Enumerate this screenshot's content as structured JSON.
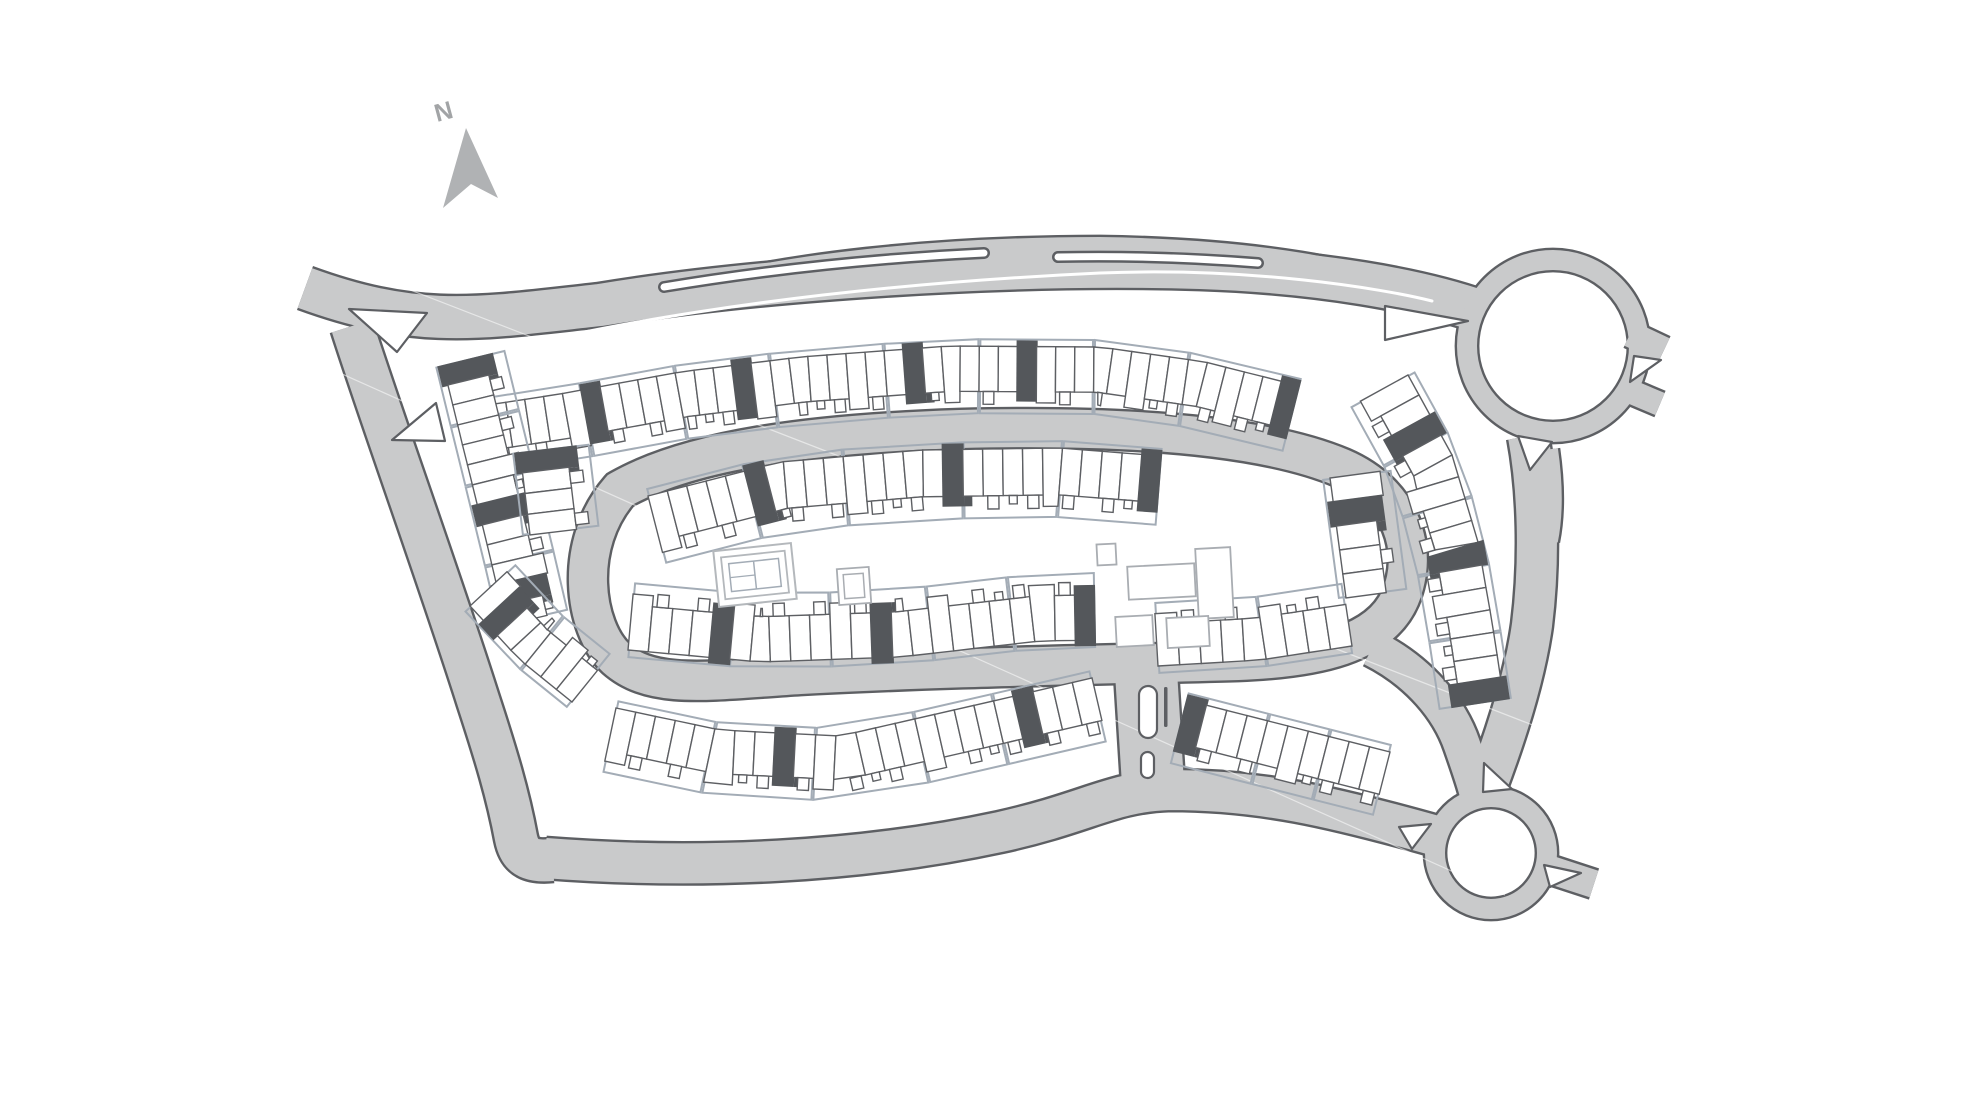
{
  "compass": {
    "label": "N",
    "arrow": [
      [
        466,
        128
      ],
      [
        498,
        198
      ],
      [
        471,
        184
      ],
      [
        443,
        208
      ]
    ],
    "label_pos": [
      437,
      122
    ],
    "label_rot": -15
  },
  "colors": {
    "background": "#ffffff",
    "road_fill": "#c9cacb",
    "road_casing": "#5d5f63",
    "plot_line": "#a3acb6",
    "building_line": "#5d5f63",
    "dark_unit": "#54575b",
    "amenity_line": "#a9adb2",
    "tennis_line": "#b4b8bc",
    "compass_fill": "#b0b2b4",
    "compass_label": "#a2a4a6",
    "island_fill": "#ffffff"
  },
  "map": {
    "roads": [
      {
        "id": "main-avenue",
        "d": "M 305,288 C 420,330 480,318 600,305 C 750,280 1000,262 1200,268 C 1320,272 1420,290 1482,312",
        "w": 42
      },
      {
        "id": "north-bypass",
        "d": "M 648,302 C 780,262 950,248 1100,248 C 1250,250 1360,268 1470,308",
        "w": 22
      },
      {
        "id": "west-road",
        "d": "M 352,326 C 382,420 440,580 478,700 C 496,755 508,795 516,838 C 520,858 532,862 552,860",
        "w": 42
      },
      {
        "id": "south-road",
        "d": "M 545,858 C 700,870 860,862 1000,832 C 1090,812 1110,792 1170,790 C 1260,790 1330,806 1440,837",
        "w": 40
      },
      {
        "id": "east-road",
        "d": "M 1528,436 C 1538,490 1540,560 1532,625 C 1525,675 1508,730 1486,788",
        "w": 40
      },
      {
        "id": "east-road-bulge",
        "d": "M 1545,450 C 1550,485 1550,515 1545,540",
        "w": 26
      },
      {
        "id": "ring-road",
        "d": "M 620,490 C 690,450 810,434 960,429 C 1120,425 1262,434 1342,468 C 1402,494 1420,550 1400,598 C 1380,644 1318,658 1238,661 C 1100,665 950,667 800,675 C 706,681 652,690 616,658 C 584,628 572,545 620,490 Z",
        "w": 38
      },
      {
        "id": "ring-southeast-link",
        "d": "M 1372,648 C 1420,672 1450,710 1462,745 C 1470,768 1475,782 1478,795",
        "w": 36
      },
      {
        "id": "south-connector",
        "d": "M 1145,656 L 1154,800",
        "w": 62
      },
      {
        "id": "roundabout-east-stub-1",
        "d": "M 1630,334 L 1664,350",
        "w": 26
      },
      {
        "id": "roundabout-east-stub-2",
        "d": "M 1622,388 L 1660,404",
        "w": 24
      },
      {
        "id": "south-roundabout-stub",
        "d": "M 1545,868 L 1594,884",
        "w": 28
      }
    ],
    "roundabouts": [
      {
        "id": "north-roundabout",
        "cx": 1553,
        "cy": 346,
        "r": 86,
        "w": 20
      },
      {
        "id": "south-roundabout",
        "cx": 1491,
        "cy": 853,
        "r": 56,
        "w": 20
      }
    ],
    "hairlines": [
      [
        [
          320,
          255
        ],
        [
          1610,
          755
        ]
      ],
      [
        [
          255,
          335
        ],
        [
          1505,
          895
        ]
      ]
    ],
    "median": {
      "d": "M 402,378 C 560,328 800,287 1100,273 C 1250,267 1380,288 1432,301"
    },
    "slots": [
      {
        "id": "layby-island-west",
        "d": "M 664,287 Q 820,261 984,253"
      },
      {
        "id": "layby-island-east",
        "d": "M 1058,257 Q 1160,255 1258,263"
      }
    ],
    "islands": [
      {
        "id": "junction-island-north",
        "pts": [
          [
            349,
            309
          ],
          [
            427,
            313
          ],
          [
            397,
            352
          ]
        ]
      },
      {
        "id": "junction-island-south",
        "pts": [
          [
            392,
            440
          ],
          [
            436,
            403
          ],
          [
            445,
            441
          ]
        ]
      },
      {
        "id": "approach-splitter",
        "pts": [
          [
            1385,
            306
          ],
          [
            1468,
            321
          ],
          [
            1385,
            340
          ]
        ]
      },
      {
        "id": "north-roundabout-sw",
        "pts": [
          [
            1518,
            436
          ],
          [
            1552,
            442
          ],
          [
            1530,
            470
          ]
        ]
      },
      {
        "id": "north-roundabout-east",
        "pts": [
          [
            1634,
            356
          ],
          [
            1661,
            360
          ],
          [
            1630,
            382
          ]
        ]
      },
      {
        "id": "south-roundabout-n",
        "pts": [
          [
            1484,
            763
          ],
          [
            1512,
            789
          ],
          [
            1483,
            792
          ]
        ]
      },
      {
        "id": "south-roundabout-w",
        "pts": [
          [
            1399,
            827
          ],
          [
            1431,
            824
          ],
          [
            1412,
            849
          ]
        ]
      },
      {
        "id": "south-roundabout-se",
        "pts": [
          [
            1544,
            865
          ],
          [
            1581,
            873
          ],
          [
            1550,
            887
          ]
        ]
      }
    ],
    "pills": [
      {
        "x": 1139,
        "y": 686,
        "w": 18,
        "h": 52,
        "r": 9
      },
      {
        "x": 1141,
        "y": 752,
        "w": 13,
        "h": 26,
        "r": 6.5
      }
    ],
    "stick": {
      "x": 1164,
      "y": 687,
      "w": 3.5,
      "h": 40
    },
    "rows": [
      {
        "id": "outer-north",
        "pts": [
          [
            468,
            408
          ],
          [
            560,
            394
          ],
          [
            680,
            372
          ],
          [
            800,
            357
          ],
          [
            950,
            346
          ],
          [
            1100,
            347
          ],
          [
            1205,
            362
          ],
          [
            1300,
            386
          ]
        ],
        "depth": 58,
        "side": 1,
        "n": 44,
        "plots": [
          6,
          5,
          5,
          6,
          5,
          6,
          5,
          6
        ],
        "darks": [
          6,
          14,
          23,
          29,
          43
        ]
      },
      {
        "id": "outer-west",
        "pts": [
          [
            443,
            365
          ],
          [
            465,
            455
          ],
          [
            488,
            548
          ],
          [
            506,
            625
          ]
        ],
        "depth": 54,
        "side": -1,
        "n": 13,
        "plots": [
          3,
          3,
          4,
          3
        ],
        "darks": [
          0,
          7,
          11
        ]
      },
      {
        "id": "southwest-corner",
        "pts": [
          [
            470,
            606
          ],
          [
            520,
            660
          ],
          [
            572,
            702
          ]
        ],
        "depth": 52,
        "side": -1,
        "n": 7,
        "plots": [
          4,
          3
        ],
        "darks": [
          1
        ]
      },
      {
        "id": "outer-south-west",
        "pts": [
          [
            616,
            708
          ],
          [
            720,
            730
          ],
          [
            840,
            736
          ],
          [
            980,
            704
          ],
          [
            1092,
            678
          ]
        ],
        "depth": 56,
        "side": 1,
        "n": 24,
        "plots": [
          5,
          5,
          5,
          4,
          5
        ],
        "darks": [
          8,
          20
        ]
      },
      {
        "id": "outer-south-east",
        "pts": [
          [
            1186,
            700
          ],
          [
            1280,
            724
          ],
          [
            1390,
            752
          ]
        ],
        "depth": 56,
        "side": 1,
        "n": 10,
        "plots": [
          4,
          3,
          3
        ],
        "darks": [
          0
        ]
      },
      {
        "id": "outer-east",
        "pts": [
          [
            1408,
            375
          ],
          [
            1452,
            455
          ],
          [
            1478,
            542
          ],
          [
            1492,
            622
          ],
          [
            1504,
            700
          ]
        ],
        "depth": 56,
        "side": 1,
        "n": 15,
        "plots": [
          3,
          3,
          3,
          3,
          3
        ],
        "darks": [
          2,
          8,
          14
        ]
      },
      {
        "id": "inner-north",
        "pts": [
          [
            648,
            496
          ],
          [
            780,
            462
          ],
          [
            920,
            450
          ],
          [
            1060,
            448
          ],
          [
            1162,
            456
          ]
        ],
        "depth": 60,
        "side": 1,
        "n": 26,
        "plots": [
          5,
          5,
          6,
          5,
          5
        ],
        "darks": [
          5,
          15,
          25
        ]
      },
      {
        "id": "inner-south",
        "pts": [
          [
            628,
            650
          ],
          [
            760,
            662
          ],
          [
            900,
            657
          ],
          [
            1040,
            641
          ],
          [
            1096,
            640
          ]
        ],
        "depth": 58,
        "side": -1,
        "n": 23,
        "plots": [
          5,
          5,
          5,
          4,
          4
        ],
        "darks": [
          4,
          12,
          22
        ]
      },
      {
        "id": "inner-south-east",
        "pts": [
          [
            1158,
            666
          ],
          [
            1260,
            660
          ],
          [
            1352,
            646
          ]
        ],
        "depth": 54,
        "side": -1,
        "n": 9,
        "plots": [
          5,
          4
        ],
        "darks": []
      },
      {
        "id": "inner-west",
        "pts": [
          [
            520,
            452
          ],
          [
            530,
            535
          ]
        ],
        "depth": 60,
        "side": -1,
        "n": 4,
        "plots": [
          4
        ],
        "darks": [
          0
        ]
      },
      {
        "id": "inner-east",
        "pts": [
          [
            1330,
            478
          ],
          [
            1346,
            598
          ]
        ],
        "depth": 52,
        "side": -1,
        "n": 5,
        "plots": [
          5
        ],
        "darks": [
          1
        ]
      }
    ],
    "amenities": [
      {
        "id": "community-hall",
        "x": 1128,
        "y": 565,
        "w": 67,
        "h": 33,
        "rot": -3,
        "double": false
      },
      {
        "id": "apartment-block",
        "x": 1197,
        "y": 548,
        "w": 35,
        "h": 70,
        "rot": -3,
        "double": false
      },
      {
        "id": "lodge-1",
        "x": 1116,
        "y": 616,
        "w": 37,
        "h": 30,
        "rot": -3,
        "double": false
      },
      {
        "id": "lodge-2",
        "x": 1167,
        "y": 617,
        "w": 42,
        "h": 30,
        "rot": -3,
        "double": false
      },
      {
        "id": "kiosk",
        "x": 1097,
        "y": 544,
        "w": 19,
        "h": 21,
        "rot": -3,
        "double": false
      },
      {
        "id": "garden-pad",
        "x": 838,
        "y": 568,
        "w": 32,
        "h": 36,
        "rot": -4,
        "double": true
      }
    ],
    "tennis": {
      "x": 716,
      "y": 547,
      "w": 78,
      "h": 56,
      "rot": -6
    }
  }
}
